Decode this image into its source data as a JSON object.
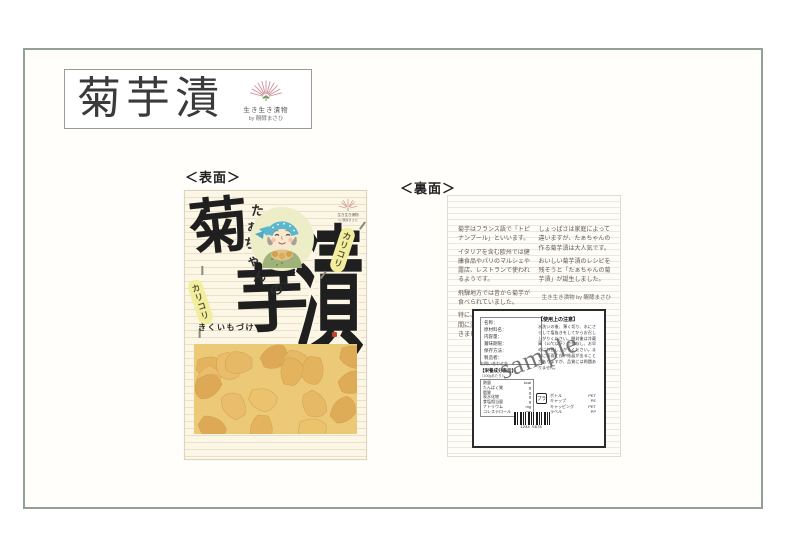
{
  "header": {
    "title": "菊芋漬",
    "brand": {
      "line1": "生き生き漬物",
      "line2": "by 醗酵まさひ"
    }
  },
  "sections": {
    "front_label": "＜表面＞",
    "back_label": "＜裏面＞"
  },
  "front": {
    "kanji_kiku": "菊",
    "kanji_imo": "芋",
    "kanji_tsuke": "漬",
    "taachan": "たぁちゃんの",
    "taachan_chars": [
      "た",
      "ぁ",
      "ち",
      "ゃ",
      "ん",
      "の"
    ],
    "karikori": "カリコリ",
    "reading": "きくいもづけ"
  },
  "back": {
    "left_paragraphs": [
      "菊芋はフランス語で「トピナンブール」といいます。",
      "イタリアを含む欧州では健康食品やパリのマルシェや露店、レストランで使われるようです。",
      "飛騨地方では昔から菊芋が食べられていました。",
      "特に、野菜の穫れない冬の間に漬物にして食べられてきました。"
    ],
    "right_paragraphs": [
      "しょっぱさは家庭によって違いますが、たぁちゃんの作る菊芋漬は大人気です。",
      "おいしい菊芋漬のレシピを残そうと「たぁちゃんの菊芋漬」が誕生しました。"
    ],
    "credit": "生き生き漬物 by 醗酵まさひ",
    "label": {
      "info_rows": [
        "名称：",
        "原材料名：",
        "内容量：",
        "賞味期限：",
        "保存方法：",
        "製造者："
      ],
      "contact": "お問い合わせ先",
      "notice_title": "【使用上の注意】",
      "notice_body": "水洗いの後、薄く切り、水にさらして塩抜きをしてからお召し上がりください。開封後は冷蔵庫（10℃以下）で保存し、お早めにお召し上がりください。まれに表面に白い結晶が出ることがありますが、品質には問題ありません。",
      "nutrition_title": "【栄養成分表示】",
      "nutrition_sub": "（100gあたり）",
      "nutrition_rows": [
        {
          "n": "熱量",
          "u": "kcal"
        },
        {
          "n": "たんぱく質",
          "u": "g"
        },
        {
          "n": "脂質",
          "u": "g"
        },
        {
          "n": "炭水化物",
          "u": "g"
        },
        {
          "n": "食塩相当量",
          "u": "g"
        },
        {
          "n": "ナトリウム",
          "u": "mg"
        },
        {
          "n": "コレステロール",
          "u": "mg"
        }
      ],
      "recycle_mark": "プラ",
      "materials": [
        {
          "n": "ボトル",
          "m": "PET"
        },
        {
          "n": "キャップ",
          "m": "PE"
        },
        {
          "n": "キャッピング",
          "m": "PET"
        },
        {
          "n": "ラベル",
          "m": "PP"
        }
      ],
      "barcode_digits": "1234 5678",
      "watermark": "sample"
    }
  },
  "colors": {
    "sheet_border": "#93a098",
    "package_cream": "#fbf6e6",
    "kanji_ink": "#1f1f1f",
    "scarf_teal": "#5cb6cd",
    "capsule_yellow": "#f2ee9e",
    "pickle_orange": "#eac263",
    "logo_pink": "#cf8e99",
    "sprout_green": "#6f9c55"
  }
}
